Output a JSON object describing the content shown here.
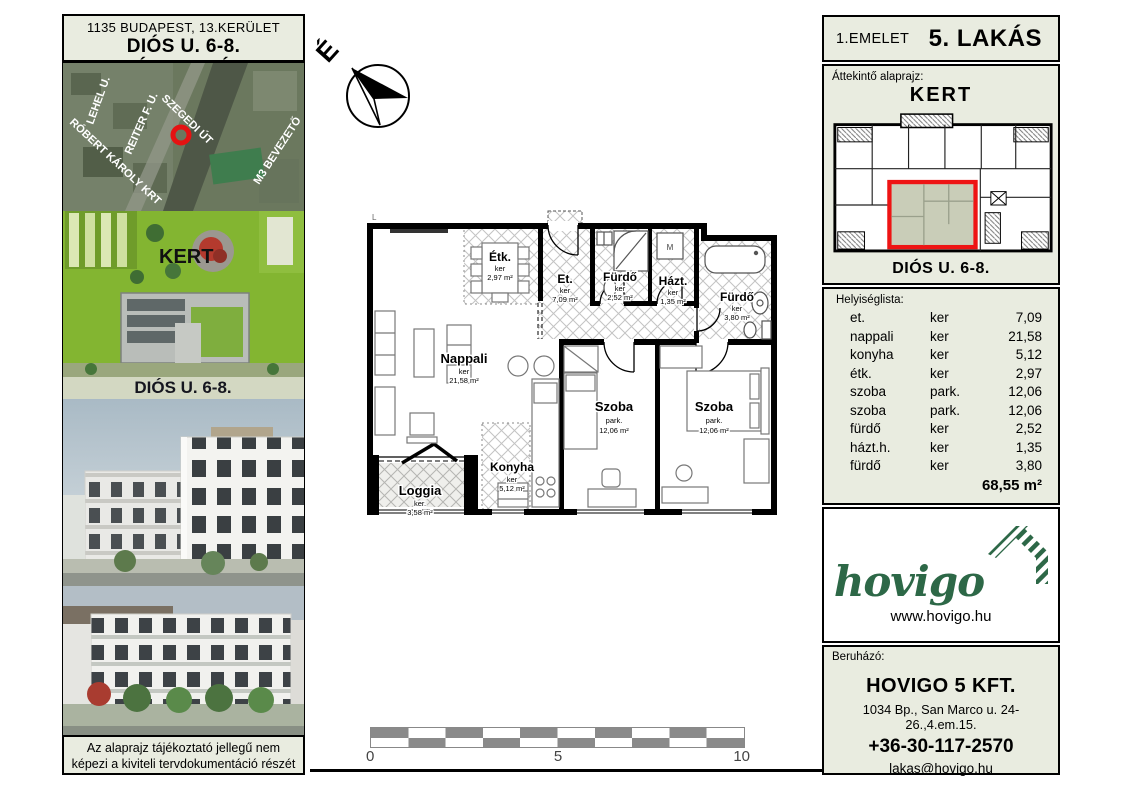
{
  "colors": {
    "panel_bg": "#e9ece0",
    "accent_red": "#ee1414",
    "brand_green": "#2d6847",
    "scale_gray": "#8a8a8a",
    "highlight_fill": "#c9cdb8"
  },
  "left_panel": {
    "header": {
      "line1": "1135 BUDAPEST, 13.KERÜLET",
      "line2": "DIÓS U. 6-8. TÁRSASHÁZ"
    },
    "map": {
      "streets": [
        "LEHEL U.",
        "RÓBERT KÁROLY KRT",
        "REITER F. U.",
        "SZEGEDI ÚT",
        "M3 BEVEZETŐ"
      ]
    },
    "garden": {
      "label": "KERT",
      "street_label": "DIÓS U. 6-8."
    },
    "disclaimer": {
      "line1": "Az alaprajz tájékoztató jellegű nem",
      "line2": "képezi a kiviteli tervdokumentáció részét"
    }
  },
  "plan": {
    "corner_label": "L",
    "north_label": "É",
    "washer_label": "M",
    "rooms": [
      {
        "name": "Étk.",
        "floor": "ker",
        "area": "2,97 m²"
      },
      {
        "name": "Et.",
        "floor": "ker",
        "area": "7,09 m²"
      },
      {
        "name": "Fürdő",
        "floor": "ker",
        "area": "2,52 m²"
      },
      {
        "name": "Házt.",
        "floor": "ker",
        "area": "1,35 m²"
      },
      {
        "name": "Fürdő",
        "floor": "ker",
        "area": "3,80 m²"
      },
      {
        "name": "Nappali",
        "floor": "ker",
        "area": "21,58 m²"
      },
      {
        "name": "Konyha",
        "floor": "ker",
        "area": "5,12 m²"
      },
      {
        "name": "Szoba",
        "floor": "park.",
        "area": "12,06 m²"
      },
      {
        "name": "Szoba",
        "floor": "park.",
        "area": "12,06 m²"
      },
      {
        "name": "Loggia",
        "floor": "ker.",
        "area": "3,58 m²"
      }
    ],
    "scale": {
      "start": "0",
      "mid": "5",
      "end": "10"
    }
  },
  "right_panel": {
    "header": {
      "floor": "1.EMELET",
      "unit": "5. LAKÁS"
    },
    "overview": {
      "title": "Áttekintő alaprajz:",
      "top_label": "KERT",
      "bottom_label": "DIÓS U. 6-8."
    },
    "room_list": {
      "title": "Helyiséglista:",
      "rows": [
        {
          "name": "et.",
          "floor": "ker",
          "area": "7,09"
        },
        {
          "name": "nappali",
          "floor": "ker",
          "area": "21,58"
        },
        {
          "name": "konyha",
          "floor": "ker",
          "area": "5,12"
        },
        {
          "name": "étk.",
          "floor": "ker",
          "area": "2,97"
        },
        {
          "name": "szoba",
          "floor": "park.",
          "area": "12,06"
        },
        {
          "name": "szoba",
          "floor": "park.",
          "area": "12,06"
        },
        {
          "name": "fürdő",
          "floor": "ker",
          "area": "2,52"
        },
        {
          "name": "házt.h.",
          "floor": "ker",
          "area": "1,35"
        },
        {
          "name": "fürdő",
          "floor": "ker",
          "area": "3,80"
        }
      ],
      "total": "68,55 m²",
      "loggia": {
        "name": "loggia",
        "floor": "ker.",
        "area": "3,58"
      },
      "loggia_total": "3,58 m²"
    },
    "logo": {
      "brand": "hovigo",
      "website": "www.hovigo.hu"
    },
    "developer": {
      "title": "Beruházó:",
      "company": "HOVIGO 5 KFT.",
      "address": "1034 Bp., San Marco u. 24-26.,4.em.15.",
      "phone": "+36-30-117-2570",
      "email": "lakas@hovigo.hu"
    }
  }
}
